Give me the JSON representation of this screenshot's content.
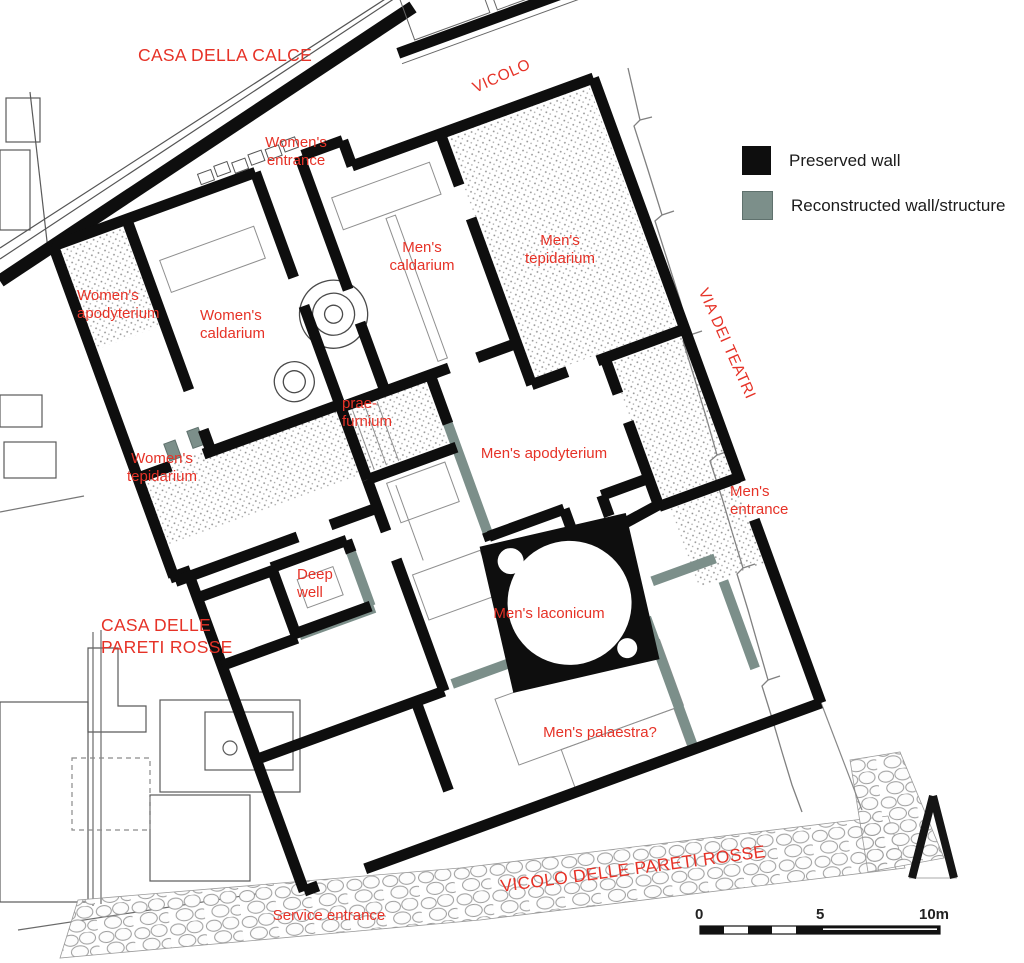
{
  "figure": {
    "type": "excavation-plan",
    "colors": {
      "wall_preserved": "#0e0e0e",
      "wall_reconstructed": "#7c8f8a",
      "label_red": "#e63227"
    }
  },
  "legend": {
    "items": [
      {
        "name": "preserved-wall",
        "label": "Preserved wall",
        "color": "#0e0e0e"
      },
      {
        "name": "reconstructed-wall",
        "label": "Reconstructed wall/structure",
        "color": "#7c8f8a"
      }
    ]
  },
  "labels": {
    "casa_della_calce": "CASA DELLA CALCE",
    "vicolo": "VICOLO",
    "womens_entrance": "Women's\nentrance",
    "mens_caldarium": "Men's\ncaldarium",
    "mens_tepidarium": "Men's\ntepidarium",
    "womens_apodyterium": "Women's\napodyterium",
    "womens_caldarium": "Women's\ncaldarium",
    "via_dei_teatri": "VIA DEI TEATRI",
    "prae_furnium": "prae-\nfurnium",
    "mens_apodyterium": "Men's apodyterium",
    "womens_tepidarium": "Women's\ntepidarium",
    "mens_entrance": "Men's\nentrance",
    "deep_well": "Deep\nwell",
    "casa_delle_pareti_rosse": "CASA DELLE\nPARETI ROSSE",
    "mens_laconicum": "Men's laconicum",
    "mens_palaestra": "Men's palaestra?",
    "vicolo_delle_pareti_rosse": "VICOLO DELLE PARETI ROSSE",
    "service_entrance": "Service entrance"
  },
  "scale_bar": {
    "tick0": "0",
    "tick5": "5",
    "tick10": "10m"
  }
}
